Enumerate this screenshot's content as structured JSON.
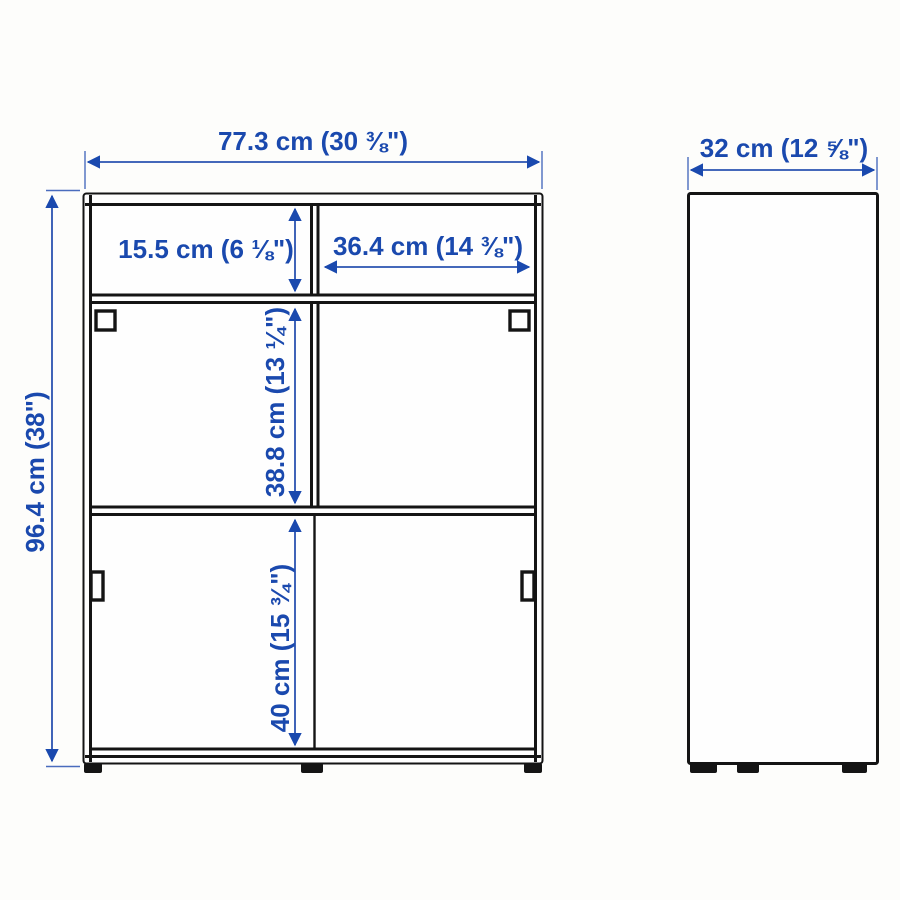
{
  "diagram_title": "cabinet-dimension-diagram",
  "colors": {
    "accent_blue": "#1a49ae",
    "line_black": "#141414",
    "background": "#fdfdfb"
  },
  "front_view": {
    "width_label": "77.3 cm (30 ⅜\")",
    "height_label": "96.4 cm (38\")",
    "top_compartment_height_label": "15.5 cm (6 ⅛\")",
    "top_compartment_width_label": "36.4 cm (14 ⅜\")",
    "middle_compartment_height_label": "38.8 cm (13 ¼\")",
    "bottom_compartment_height_label": "40 cm (15 ¾\")"
  },
  "side_view": {
    "depth_label": "32 cm (12 ⅝\")"
  }
}
